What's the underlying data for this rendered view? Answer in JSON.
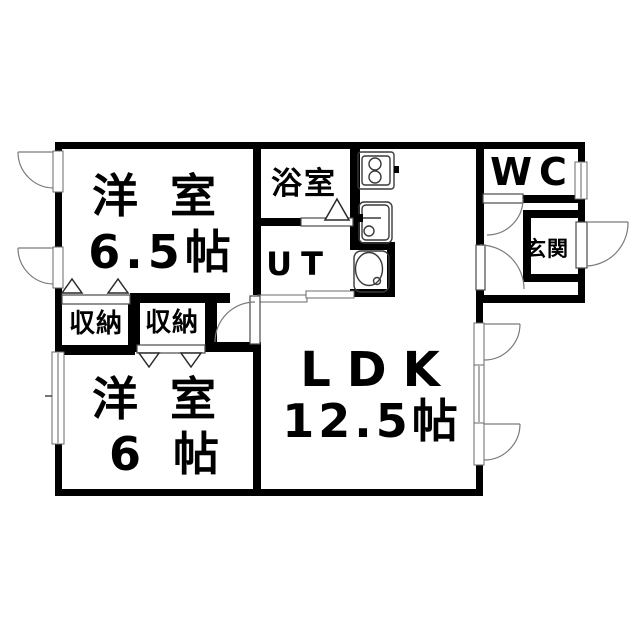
{
  "floorplan": {
    "title": "apartment-floor-plan",
    "rooms": {
      "bedroom1": {
        "name": "洋 室",
        "size": "6.5帖"
      },
      "bedroom2": {
        "name": "洋 室",
        "size": "6 帖"
      },
      "ldk": {
        "name": "LDK",
        "size": "12.5帖"
      },
      "bathroom": {
        "name": "浴室"
      },
      "utility": {
        "name": "UT"
      },
      "toilet_room": {
        "name": "WC"
      },
      "entrance": {
        "name": "玄関"
      },
      "closet1": {
        "name": "収納"
      },
      "closet2": {
        "name": "収納"
      }
    },
    "fixtures": [
      "stove-icon",
      "kitchen-sink-icon",
      "wash-basin-icon"
    ],
    "symbols": [
      "casement-window",
      "sliding-window",
      "sliding-door",
      "folding-door-marker",
      "door-swing-arc"
    ],
    "colors": {
      "wall": "#000000",
      "background": "#ffffff",
      "fixture_line": "#3a3a3a",
      "swing_line": "#7a7a7a"
    }
  }
}
